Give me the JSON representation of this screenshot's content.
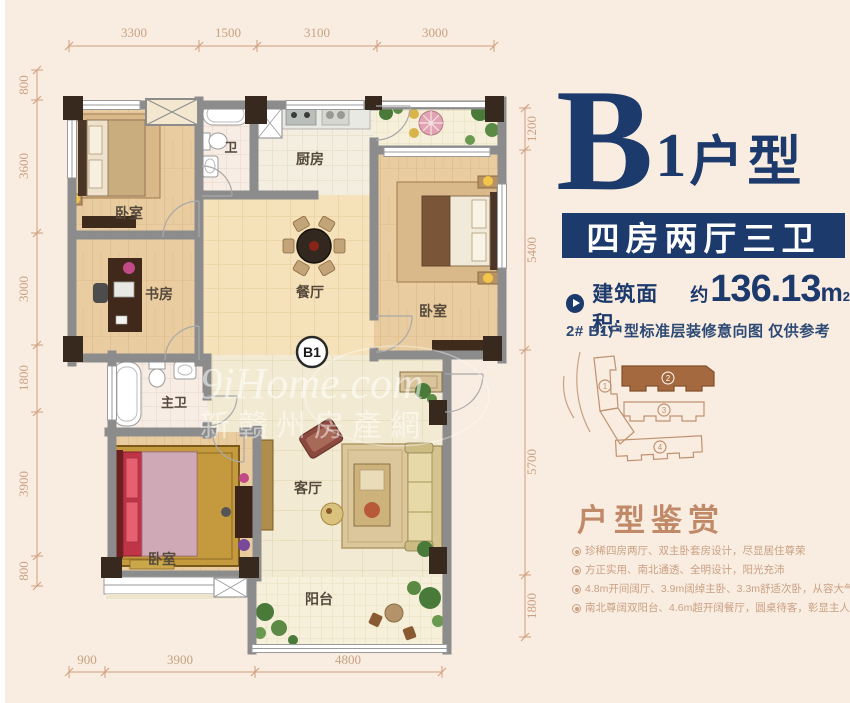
{
  "colors": {
    "navy": "#1c3a6b",
    "tan": "#c9a183",
    "bg": "#f9ece1",
    "wall": "#8c8c8c",
    "highlight": "#a5693f"
  },
  "plan": {
    "badge": "B1",
    "rooms": {
      "bedroom_tl": "卧室",
      "study": "书房",
      "bath": "卫",
      "kitchen": "厨房",
      "bedroom_right": "卧室",
      "dining": "餐厅",
      "master_bath": "主卫",
      "bedroom_bl": "卧室",
      "living": "客厅",
      "balcony": "阳台"
    },
    "dims": {
      "top": [
        "3300",
        "1500",
        "3100",
        "3000"
      ],
      "left": [
        "800",
        "3600",
        "3000",
        "1800",
        "3900",
        "800"
      ],
      "right": [
        "1200",
        "5400",
        "5700",
        "1800"
      ],
      "bottom": [
        "900",
        "3900",
        "4800"
      ]
    },
    "watermark": {
      "line1": "9iHome.com",
      "line2": "新赣州房產網"
    }
  },
  "panel": {
    "title": {
      "letter": "B",
      "num": "1",
      "type": "户型"
    },
    "layout_bar": "四房两厅三卫",
    "area": {
      "label": "建筑面积:",
      "approx": "约",
      "value": "136.13",
      "unit": "m",
      "sup": "2"
    },
    "note": "2# B1户型标准层装修意向图 仅供参考",
    "siteplan": {
      "b1": "1",
      "b2": "2",
      "b3": "3",
      "b4": "4"
    },
    "appreciation": {
      "heading": "户型鉴赏",
      "bullets": [
        "珍稀四房两厅、双主卧套房设计，尽显居住尊荣",
        "方正实用、南北通透、全明设计，阳光充沛",
        "4.8m开间阔厅、3.9m阔绰主卧、3.3m舒适次卧，从容大气",
        "南北尊阔双阳台、4.6m超开阔餐厅，圆桌待客，彰显主人胸襟气度"
      ]
    }
  }
}
